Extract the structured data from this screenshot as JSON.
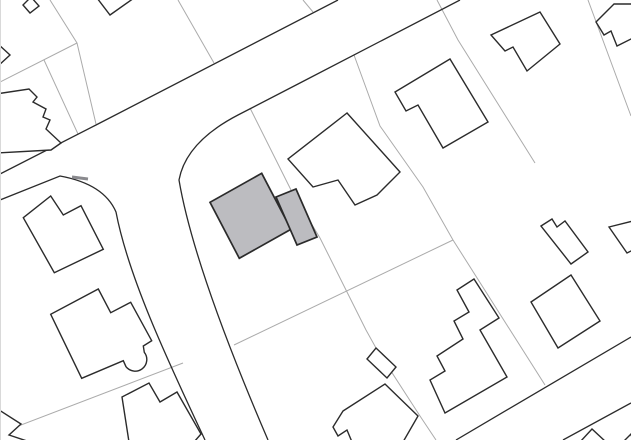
{
  "map": {
    "type": "site-plan",
    "canvas": {
      "width": 631,
      "height": 440,
      "background": "#ffffff"
    },
    "colors": {
      "building_outline": "#2b2b2b",
      "building_fill": "#ffffff",
      "highlight_fill": "#bcbcc0",
      "parcel_line": "#ababab",
      "road_line": "#2b2b2b",
      "curb_mark": "#8a8a8e",
      "edge_border": "#d9d9d9"
    },
    "layers": [
      {
        "name": "parcel-lines",
        "style": {
          "stroke": "#ababab",
          "width": 1,
          "fill": "none"
        },
        "paths": [
          {
            "name": "parcel-line",
            "d": "M0,82 L77,43"
          },
          {
            "name": "parcel-line",
            "d": "M50,0 L77,43 L96,124"
          },
          {
            "name": "parcel-line",
            "d": "M44,60 L78,134"
          },
          {
            "name": "parcel-line",
            "d": "M178,0 L214,63"
          },
          {
            "name": "parcel-line",
            "d": "M303,0 L313,12"
          },
          {
            "name": "parcel-line",
            "d": "M250,108 L291,190 L320,238 L366,330 L376,348 L420,416 L436,440"
          },
          {
            "name": "parcel-line",
            "d": "M354,55 L380,126 L423,187 L453,240"
          },
          {
            "name": "parcel-line",
            "d": "M234,345 L453,240"
          },
          {
            "name": "parcel-line",
            "d": "M453,240 L545,385"
          },
          {
            "name": "parcel-line",
            "d": "M437,0 L458,40 L535,163"
          },
          {
            "name": "parcel-line",
            "d": "M588,0 L628,108 L631,116"
          },
          {
            "name": "parcel-line",
            "d": "M0,433 L183,363"
          }
        ]
      },
      {
        "name": "road-edges",
        "style": {
          "stroke": "#2b2b2b",
          "width": 1.3,
          "fill": "none"
        },
        "paths": [
          {
            "name": "road-edge-upper",
            "d": "M338,0 L96,125 L0,174"
          },
          {
            "name": "road-edge-lower-east",
            "d": "M460,0 L298,84 L238,115 Q186,142 179,180 C190,245 225,340 268,440"
          },
          {
            "name": "road-edge-lower-west",
            "d": "M0,200 L60,176 Q104,184 116,212 C128,275 165,355 205,440"
          },
          {
            "name": "road2-edge-north",
            "d": "M631,337 L456,440"
          },
          {
            "name": "road2-edge-south",
            "d": "M631,403 L563,440"
          }
        ]
      },
      {
        "name": "buildings",
        "style": {
          "stroke": "#2b2b2b",
          "width": 1.4,
          "fill": "#ffffff"
        },
        "paths": [
          {
            "name": "building-top-left-corner",
            "d": "M23,5 L31,-3 L39,6 L30,13 Z"
          },
          {
            "name": "building-top-notch",
            "d": "M97,-2 L110,15 L134,-2 Z"
          },
          {
            "name": "building-left-edge-small",
            "d": "M-2,44 L10,55 L-2,66 Z"
          },
          {
            "name": "building-left-stepped",
            "d": "M-4,94 L29,89 L37,97 L33,102 L46,109 L43,117 L50,120 L46,129 L61,143 L51,150 L-4,153 Z"
          },
          {
            "name": "building-notched-house-west",
            "d": "M50.7,196 L63.3,215 L81,205.7 L103.3,249.3 L54.3,272.7 L23.3,217.7 Z"
          },
          {
            "name": "building-bay-house-southwest",
            "d": "M98.3,289 L110.7,312.7 L130.7,302.3 L151.7,340.7 L143.3,346 L144.3,352.3 A11.5,11.5 0 0 1 126,366.7 L123.3,360.7 L81.7,378.3 L50.7,314.3 Z"
          },
          {
            "name": "building-bottom-left",
            "d": "M122,397 L149,383 L160,402 L177,392 L201,434 L194,442 L129,442 Z"
          },
          {
            "name": "building-bottom-left-corner",
            "d": "M-4,408 L21,424 L9,435 L30,442 L-4,442 Z"
          },
          {
            "name": "building-center-north",
            "d": "M347,113 L288,159 L313,187 L338,180 L355,205 L377,195 L400,172 Z"
          },
          {
            "name": "building-north-notched",
            "d": "M450,59 L395,92 L406,111 L418,105 L443,148 L488,122 Z"
          },
          {
            "name": "building-top-right",
            "d": "M540,12 L491,35 L505,51 L513,47 L527,71 L560,44 Z"
          },
          {
            "name": "building-top-right-edge",
            "d": "M614,4 L596,22 L604,35 L611,31 L617,46 L633,38 L633,4 Z"
          },
          {
            "name": "building-right-bar",
            "d": "M541,226 L552,219 L557,227 L565,221 L588,252 L571,264 Z"
          },
          {
            "name": "building-right-edge",
            "d": "M609,227 L627,253 L633,250 L633,221 Z"
          },
          {
            "name": "building-stepped-south",
            "d": "M474,279 L457,290 L469,312 L454,321 L463,339 L437,356 L445,371 L430,380 L445,413 L507,377 L480,330 L499,318 Z"
          },
          {
            "name": "building-diamond-southeast",
            "d": "M571,275 L600,321 L558,348 L531,302 Z"
          },
          {
            "name": "building-small-square",
            "d": "M376,348 L396,367 L387,378 L367,359 Z"
          },
          {
            "name": "building-bottom-center",
            "d": "M343,411 L385,384 L418,416 L403,442 L352,442 L347,430 L338,436 L333,427 Z"
          },
          {
            "name": "building-bottom-right-partial",
            "d": "M580,442 L592,429 L606,442 Z"
          },
          {
            "name": "building-corner-southeast",
            "d": "M623,442 L631,434 L633,442 Z"
          }
        ]
      },
      {
        "name": "highlighted-buildings",
        "style": {
          "stroke": "#2b2b2b",
          "width": 1.7,
          "fill": "#bcbcc0"
        },
        "paths": [
          {
            "name": "highlighted-building-main",
            "d": "M261.7,173.3 L291,229.3 L239.3,258.3 L210,202.3 Z"
          },
          {
            "name": "highlighted-building-annex",
            "d": "M276,197 L296,189 L317,237 L297,245 Z"
          }
        ]
      },
      {
        "name": "decorations",
        "style": {
          "stroke": "#8a8a8e",
          "width": 3,
          "fill": "none"
        },
        "paths": [
          {
            "name": "curb-mark",
            "d": "M72,177 L88,179"
          },
          {
            "name": "canvas-left-border",
            "d": "M0.5,0 L0.5,440",
            "stroke": "#d9d9d9",
            "width": 1
          }
        ]
      }
    ]
  }
}
